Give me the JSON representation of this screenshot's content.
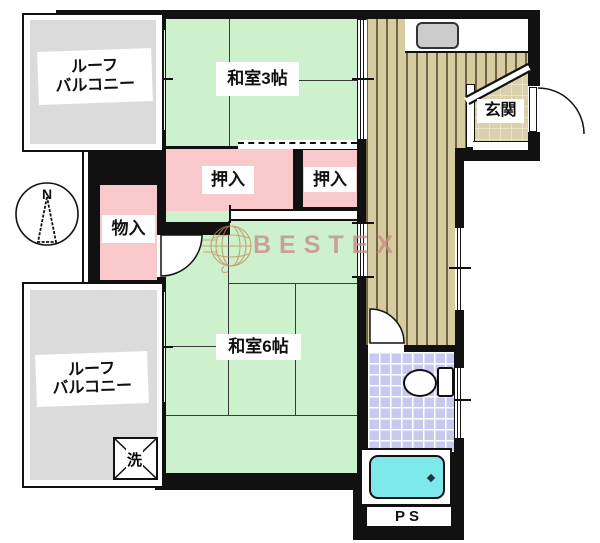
{
  "title": "apartment-floor-plan",
  "labels": {
    "balcony_top": {
      "line1": "ルーフ",
      "line2": "バルコニー"
    },
    "washitsu3": "和室3帖",
    "oshiire_left": "押入",
    "oshiire_right": "押入",
    "monoire": "物入",
    "washitsu6": "和室6帖",
    "genkan": "玄関",
    "balcony_bottom": {
      "line1": "ルーフ",
      "line2": "バルコニー"
    },
    "laundry": "洗",
    "pipe_space": "PS",
    "compass_north": "N",
    "watermark": "BESTEX"
  },
  "colors": {
    "tatami_green": "#cdf1cc",
    "closet_pink": "#f8c8ca",
    "balcony_gray": "#dbdbdb",
    "hall_floor_tan": "#d7cba0",
    "hall_stripe_dark": "#6e6547",
    "genkan_tile": "#d9d0ac",
    "bath_tile_lavender": "#c9c9ef",
    "bathtub_cyan": "#7de9ea",
    "wall_black": "#111111",
    "watermark_pink": "#c58e88",
    "globe_orange": "#c08a55"
  }
}
